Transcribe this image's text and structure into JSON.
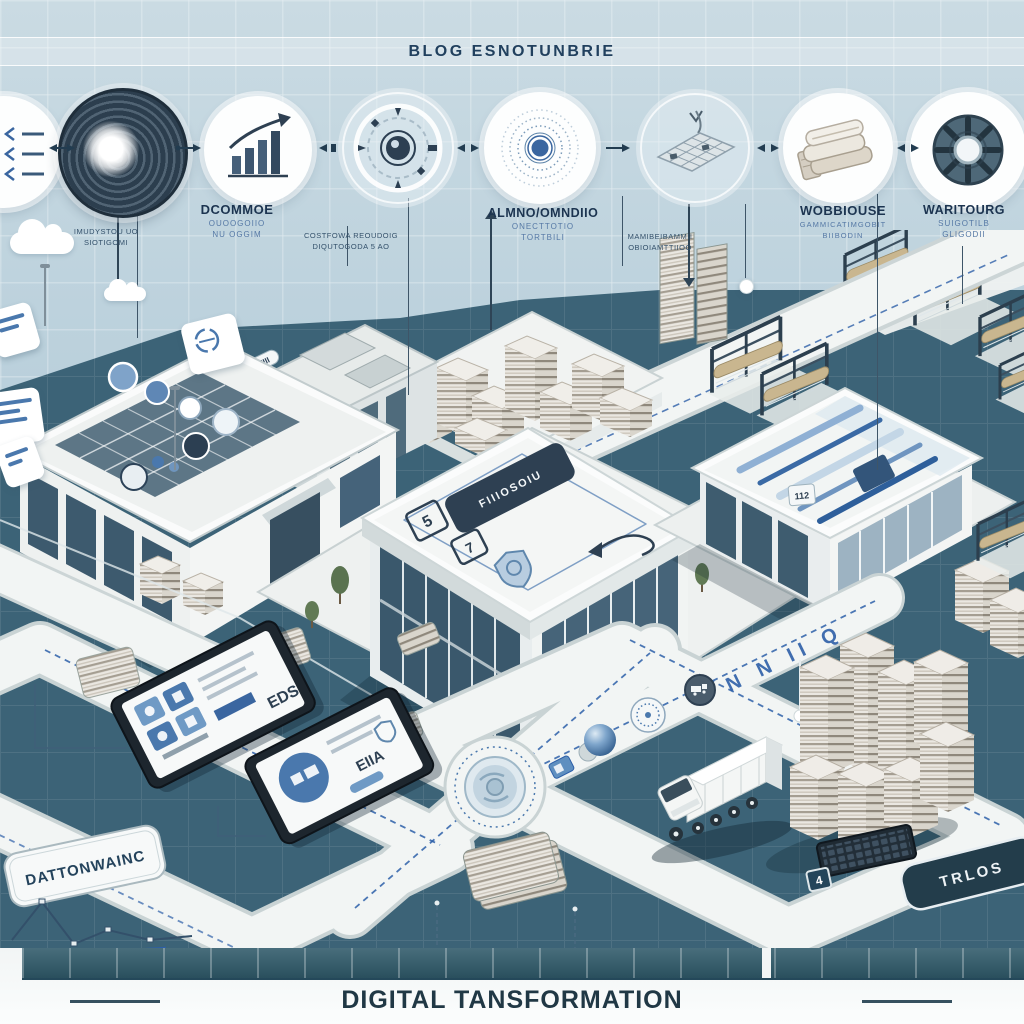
{
  "header": {
    "title": "BLOG ESNOTUNBRIE"
  },
  "process_row": {
    "icons": [
      "list-circle-icon",
      "spiral-portal-icon",
      "growth-chart-icon",
      "gauge-icon",
      "target-rings-icon",
      "keyboard-circle-icon",
      "fabric-stack-icon",
      "gear-icon"
    ],
    "labels": [
      {
        "title": "DCOMMOE",
        "sub1": "OUOOGOIIO",
        "sub2": "NU OGGIM"
      },
      {
        "title": "ALMNO/OMNDIIO",
        "sub1": "ONECTTOTIO",
        "sub2": "TORTBILI"
      },
      {
        "title": "WOBBIOUSE",
        "sub1": "GAMMICATIMGOBIT",
        "sub2": "BIIBODIN"
      },
      {
        "title": "WARITOURG",
        "sub1": "SUIGOTILB",
        "sub2": "GLIGODII"
      }
    ],
    "captions": [
      {
        "line1": "IMUDYSTOU UO",
        "line2": "SIOTIGOMI"
      },
      {
        "line1": "COSTFOWA REOUDOIG",
        "line2": "DIQUTOGODA 5 AO"
      },
      {
        "line1": "MAMIBEIBAMMII",
        "line2": "OBIOIAMTTIIOO"
      }
    ]
  },
  "scene": {
    "center_roof_plate": "FIIIOSOIU",
    "roof_glyph_a": "5",
    "roof_glyph_b": "7",
    "left_roof_badge": "EIII",
    "warehouse_badge": "112",
    "road_word": "N N II Q",
    "keyboard_badge": "4",
    "tablet1_text": "EDS",
    "tablet2_text": "EIIA",
    "sign_left": "DATTONWAINC",
    "sign_right": "TRLOS"
  },
  "banner": {
    "title": "DIGITAL TANSFORMATION"
  },
  "palette": {
    "sky_top": "#cadbe3",
    "sky_bottom": "#aac6d4",
    "ground": "#3c6377",
    "road": "#f2f5f4",
    "accent_blue": "#2d5fa8",
    "navy_text": "#21405e",
    "banner_bar": "#2f5a6a",
    "building_white": "#eef1f0",
    "glass_dark": "#3c5a6d",
    "fabric_beige": "#c9b68f"
  }
}
